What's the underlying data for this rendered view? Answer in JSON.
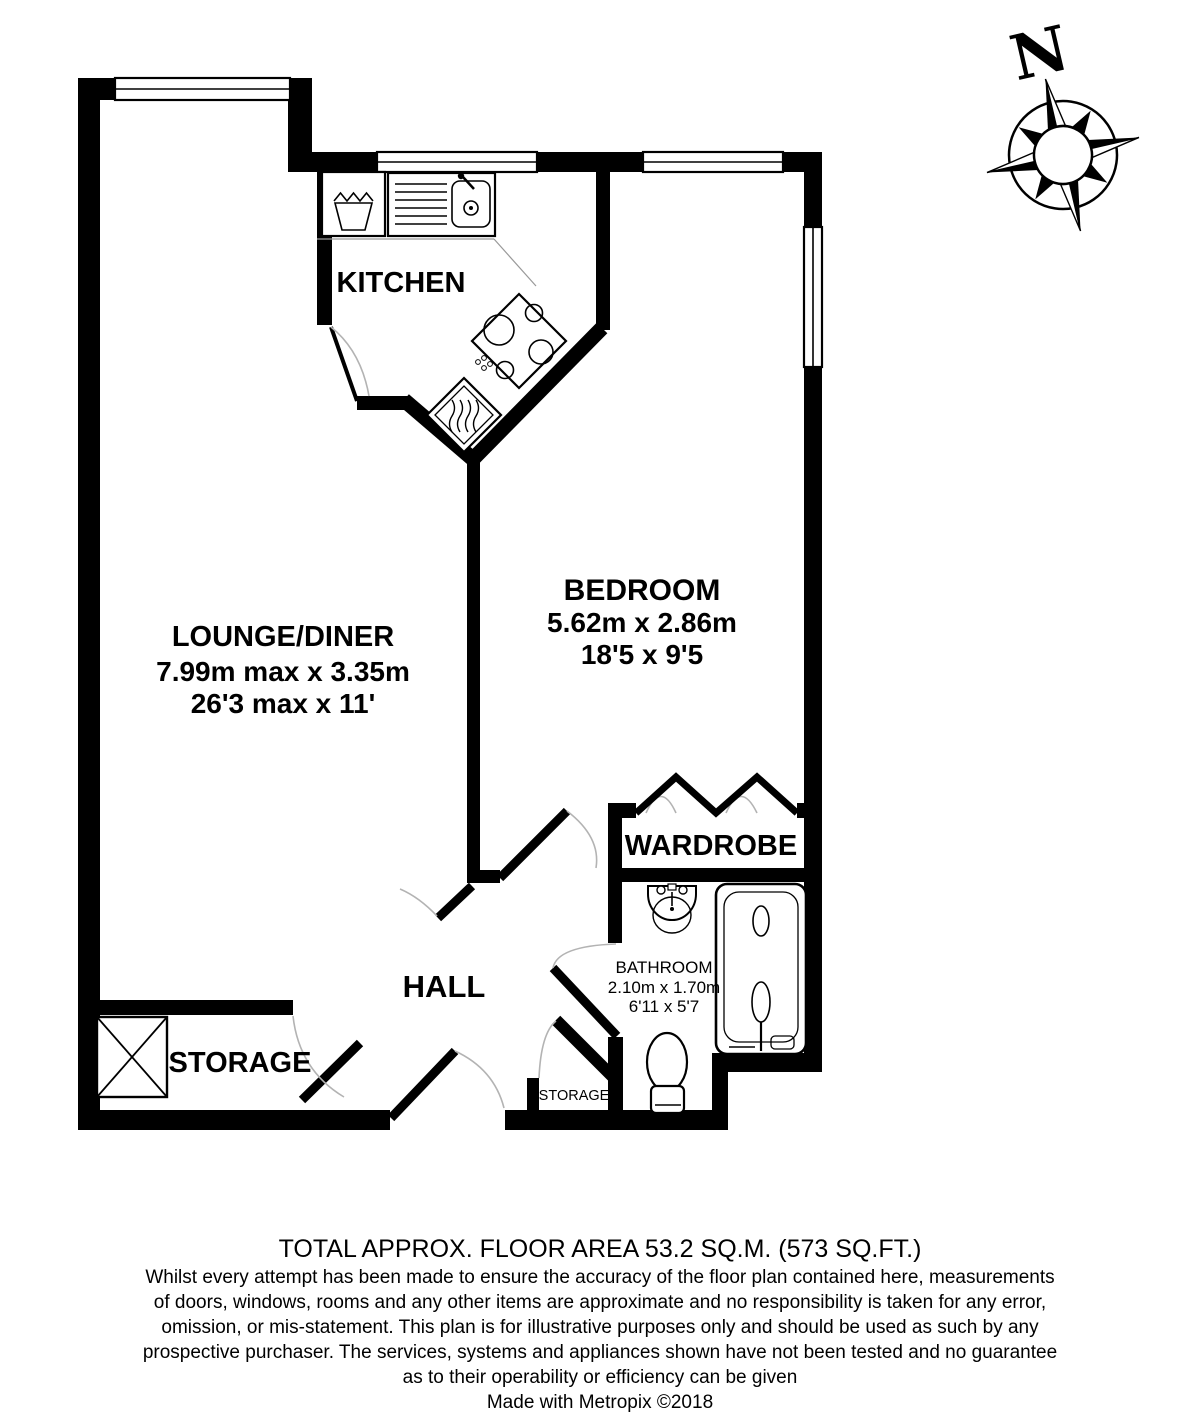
{
  "rooms": {
    "kitchen": {
      "label": "KITCHEN"
    },
    "lounge_diner": {
      "label": "LOUNGE/DINER",
      "metric": "7.99m max x 3.35m",
      "imperial": "26'3 max x 11'"
    },
    "bedroom": {
      "label": "BEDROOM",
      "metric": "5.62m x 2.86m",
      "imperial": "18'5 x 9'5"
    },
    "wardrobe": {
      "label": "WARDROBE"
    },
    "bathroom": {
      "label": "BATHROOM",
      "metric": "2.10m x 1.70m",
      "imperial": "6'11 x 5'7"
    },
    "hall": {
      "label": "HALL"
    },
    "storage": {
      "label": "STORAGE"
    },
    "storage_cupboard": {
      "label": "STORAGE"
    }
  },
  "compass": {
    "north": "N"
  },
  "footer": {
    "total_area": "TOTAL APPROX. FLOOR AREA 53.2 SQ.M. (573 SQ.FT.)",
    "disclaimer": [
      "Whilst every attempt has been made to ensure the accuracy of the floor plan contained here, measurements",
      "of doors, windows, rooms and any other items are approximate and no responsibility is taken for any error,",
      "omission, or mis-statement. This plan is for illustrative purposes only and should be used as such by any",
      "prospective purchaser. The services, systems and appliances shown have not been tested and no guarantee",
      "as to their operability or efficiency can be given"
    ],
    "credit": "Made with Metropix ©2018"
  },
  "colors": {
    "wall": "#000000",
    "background": "#ffffff",
    "door_arc": "#b3b3b3"
  }
}
